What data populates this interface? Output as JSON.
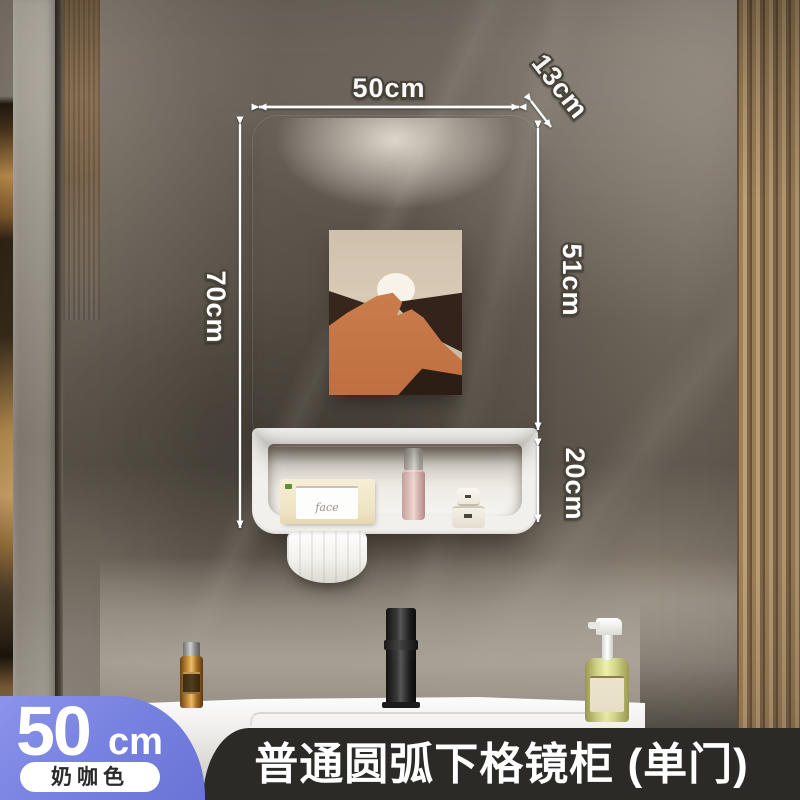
{
  "dimensions": {
    "width": "50cm",
    "depth": "13cm",
    "height": "70cm",
    "upper_right": "51cm",
    "lower_right": "20cm"
  },
  "size_badge": {
    "number": "50",
    "unit": "cm",
    "color_name": "奶咖色"
  },
  "title_bar": {
    "title": "普通圆弧下格镜柜 (单门)"
  },
  "shelf": {
    "tissue_box_text": "face"
  },
  "colors": {
    "badge_bg": "#7580DF",
    "badge_text": "#FFFFFF",
    "title_bar_bg": "#2C2A27",
    "title_text": "#FFFFFF",
    "annotation_text": "#FFFFFF",
    "mirror_tint": "#A89E93",
    "art_orange": "#C5764A",
    "art_dark": "#37261C",
    "wall": "#6B635A"
  }
}
